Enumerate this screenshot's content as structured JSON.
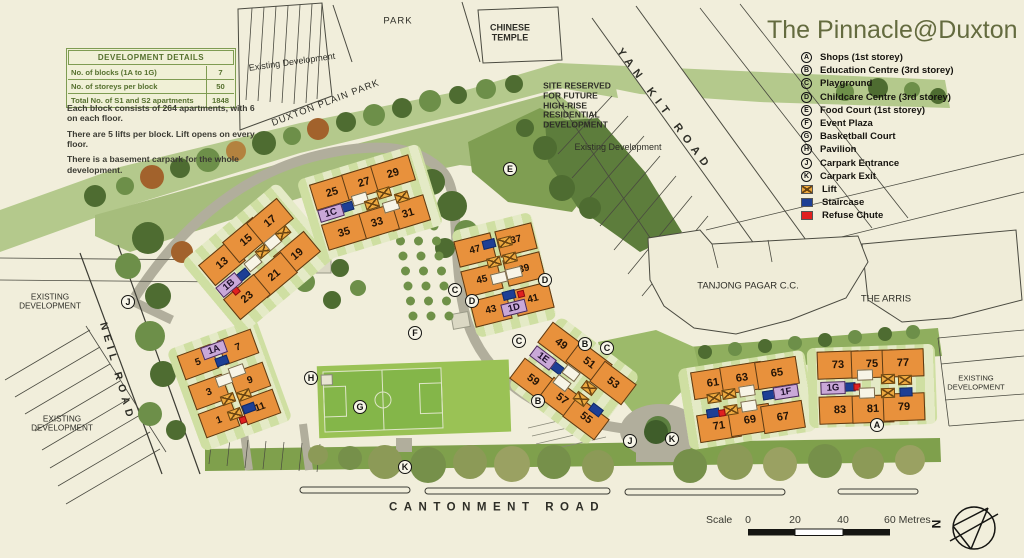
{
  "title": "The Pinnacle@Duxton",
  "legend": {
    "items": [
      {
        "symbol": "A",
        "label": "Shops (1st storey)"
      },
      {
        "symbol": "B",
        "label": "Education Centre (3rd storey)"
      },
      {
        "symbol": "C",
        "label": "Playground"
      },
      {
        "symbol": "D",
        "label": "Childcare Centre (3rd storey)"
      },
      {
        "symbol": "E",
        "label": "Food Court (1st storey)"
      },
      {
        "symbol": "F",
        "label": "Event Plaza"
      },
      {
        "symbol": "G",
        "label": "Basketball Court"
      },
      {
        "symbol": "H",
        "label": "Pavilion"
      },
      {
        "symbol": "J",
        "label": "Carpark Entrance"
      },
      {
        "symbol": "K",
        "label": "Carpark Exit"
      },
      {
        "swatch": "lift",
        "label": "Lift"
      },
      {
        "swatch": "staircase",
        "label": "Staircase"
      },
      {
        "swatch": "refuse",
        "label": "Refuse Chute"
      }
    ]
  },
  "details": {
    "header": "DEVELOPMENT DETAILS",
    "rows": [
      {
        "label": "No. of blocks (1A to 1G)",
        "value": "7"
      },
      {
        "label": "No. of storeys per block",
        "value": "50"
      },
      {
        "label": "Total No. of S1 and S2 apartments",
        "value": "1848"
      }
    ]
  },
  "notes": [
    "Each block consists of 264 apartments, with 6 on each floor.",
    "There are 5 lifts per block. Lift opens on every floor.",
    "There is a basement carpark for the whole development."
  ],
  "scale": {
    "label": "Scale",
    "t0": "0",
    "t20": "20",
    "t40": "40",
    "t60": "60 Metres",
    "north": "N"
  },
  "colors": {
    "building": "#e8913c",
    "lift": "#eda93f",
    "staircase": "#1d3f95",
    "refuse_chute": "#e02020",
    "block_label": "#c9a8d8",
    "park_band": "#b4c98c",
    "title_text": "#646b3f",
    "background": "#f1eedb"
  },
  "map": {
    "area_labels": [
      {
        "text": "PARK",
        "x": 398,
        "y": 22,
        "size": 9.5,
        "ls": 1
      },
      {
        "text": "CHINESE\nTEMPLE",
        "x": 510,
        "y": 33,
        "size": 9,
        "bold": true
      },
      {
        "text": "Existing Development",
        "x": 292,
        "y": 62,
        "rot": -8,
        "size": 9
      },
      {
        "text": "DUXTON PLAIN PARK",
        "x": 326,
        "y": 104,
        "rot": -21,
        "size": 9.5,
        "ls": 1
      },
      {
        "text": "SITE RESERVED\nFOR FUTURE\nHIGH-RISE\nRESIDENTIAL\nDEVELOPMENT",
        "x": 577,
        "y": 106,
        "size": 8.5,
        "bold": true,
        "align": "left"
      },
      {
        "text": "YAN KIT ROAD",
        "x": 664,
        "y": 110,
        "rot": 53,
        "size": 11,
        "bold": true,
        "ls": 6
      },
      {
        "text": "Existing Development",
        "x": 618,
        "y": 147,
        "size": 9
      },
      {
        "text": "TANJONG PAGAR C.C.",
        "x": 748,
        "y": 287,
        "size": 9.5
      },
      {
        "text": "THE ARRIS",
        "x": 886,
        "y": 300,
        "size": 9.5
      },
      {
        "text": "EXISTING\nDEVELOPMENT",
        "x": 976,
        "y": 383,
        "size": 7.6
      },
      {
        "text": "EXISTING\nDEVELOPMENT",
        "x": 50,
        "y": 302,
        "size": 8.2
      },
      {
        "text": "NEIL ROAD",
        "x": 117,
        "y": 372,
        "rot": 74,
        "size": 10.5,
        "bold": true,
        "ls": 5
      },
      {
        "text": "EXISTING\nDEVELOPMENT",
        "x": 62,
        "y": 424,
        "size": 8.2
      },
      {
        "text": "CANTONMENT ROAD",
        "x": 497,
        "y": 508,
        "size": 11.5,
        "bold": true,
        "ls": 6.5
      }
    ],
    "blocks": [
      {
        "id": "1A",
        "rot": -20,
        "uw": 36,
        "uh": 26,
        "fs": 10,
        "lawn": [
          95,
          108
        ],
        "lx": 214,
        "ly": 350,
        "units": [
          {
            "n": "5",
            "x": 198,
            "y": 362
          },
          {
            "n": "7",
            "x": 238,
            "y": 347
          },
          {
            "n": "3",
            "x": 209,
            "y": 392
          },
          {
            "n": "9",
            "x": 250,
            "y": 380
          },
          {
            "n": "1",
            "x": 219,
            "y": 420
          },
          {
            "n": "11",
            "x": 260,
            "y": 407
          }
        ],
        "deco": [
          {
            "t": "stair",
            "x": 222,
            "y": 361
          },
          {
            "t": "white",
            "x": 224,
            "y": 380
          },
          {
            "t": "white",
            "x": 237,
            "y": 371
          },
          {
            "t": "lift",
            "x": 228,
            "y": 399
          },
          {
            "t": "lift",
            "x": 244,
            "y": 395
          },
          {
            "t": "lift",
            "x": 235,
            "y": 414
          },
          {
            "t": "stair",
            "x": 249,
            "y": 408
          },
          {
            "t": "red",
            "x": 243,
            "y": 420
          }
        ]
      },
      {
        "id": "1B",
        "rot": -40,
        "uw": 40,
        "uh": 27,
        "fs": 11,
        "lawn": [
          125,
          95
        ],
        "lx": 229,
        "ly": 285,
        "units": [
          {
            "n": "13",
            "x": 222,
            "y": 263
          },
          {
            "n": "15",
            "x": 246,
            "y": 240
          },
          {
            "n": "17",
            "x": 270,
            "y": 221
          },
          {
            "n": "19",
            "x": 297,
            "y": 254
          },
          {
            "n": "21",
            "x": 274,
            "y": 275
          },
          {
            "n": "23",
            "x": 247,
            "y": 297
          }
        ],
        "deco": [
          {
            "t": "stair",
            "x": 243,
            "y": 275
          },
          {
            "t": "white",
            "x": 253,
            "y": 263
          },
          {
            "t": "lift",
            "x": 263,
            "y": 251
          },
          {
            "t": "white",
            "x": 273,
            "y": 242
          },
          {
            "t": "lift",
            "x": 283,
            "y": 233
          },
          {
            "t": "red",
            "x": 236,
            "y": 291
          }
        ]
      },
      {
        "id": "1C",
        "rot": -17,
        "uw": 40,
        "uh": 27,
        "fs": 11,
        "lawn": [
          128,
          85
        ],
        "lx": 331,
        "ly": 213,
        "units": [
          {
            "n": "25",
            "x": 332,
            "y": 192
          },
          {
            "n": "27",
            "x": 364,
            "y": 182
          },
          {
            "n": "29",
            "x": 393,
            "y": 173
          },
          {
            "n": "31",
            "x": 408,
            "y": 213
          },
          {
            "n": "33",
            "x": 377,
            "y": 222
          },
          {
            "n": "35",
            "x": 344,
            "y": 232
          }
        ],
        "deco": [
          {
            "t": "stair",
            "x": 347,
            "y": 207
          },
          {
            "t": "white",
            "x": 360,
            "y": 199
          },
          {
            "t": "lift",
            "x": 372,
            "y": 204
          },
          {
            "t": "lift",
            "x": 384,
            "y": 193
          },
          {
            "t": "white",
            "x": 391,
            "y": 206
          },
          {
            "t": "lift",
            "x": 402,
            "y": 197
          }
        ]
      },
      {
        "id": "1D",
        "rot": -14,
        "uw": 38,
        "uh": 27,
        "fs": 10,
        "lawn": [
          82,
          110
        ],
        "lx": 514,
        "ly": 308,
        "units": [
          {
            "n": "47",
            "x": 475,
            "y": 250
          },
          {
            "n": "37",
            "x": 516,
            "y": 240
          },
          {
            "n": "45",
            "x": 482,
            "y": 280
          },
          {
            "n": "39",
            "x": 524,
            "y": 269
          },
          {
            "n": "43",
            "x": 491,
            "y": 310
          },
          {
            "n": "41",
            "x": 533,
            "y": 299
          }
        ],
        "deco": [
          {
            "t": "stair",
            "x": 489,
            "y": 244
          },
          {
            "t": "lift",
            "x": 505,
            "y": 242
          },
          {
            "t": "lift",
            "x": 494,
            "y": 262
          },
          {
            "t": "lift",
            "x": 510,
            "y": 258
          },
          {
            "t": "white",
            "x": 499,
            "y": 278
          },
          {
            "t": "white",
            "x": 514,
            "y": 273
          },
          {
            "t": "stair",
            "x": 509,
            "y": 295
          },
          {
            "t": "red",
            "x": 521,
            "y": 294
          }
        ]
      },
      {
        "id": "1E",
        "rot": 37,
        "uw": 40,
        "uh": 26,
        "fs": 11,
        "lawn": [
          100,
          88
        ],
        "lx": 543,
        "ly": 358,
        "units": [
          {
            "n": "49",
            "x": 561,
            "y": 344
          },
          {
            "n": "51",
            "x": 589,
            "y": 363
          },
          {
            "n": "53",
            "x": 613,
            "y": 383
          },
          {
            "n": "59",
            "x": 533,
            "y": 380
          },
          {
            "n": "57",
            "x": 562,
            "y": 399
          },
          {
            "n": "55",
            "x": 586,
            "y": 418
          }
        ],
        "deco": [
          {
            "t": "stair",
            "x": 557,
            "y": 368
          },
          {
            "t": "white",
            "x": 571,
            "y": 373
          },
          {
            "t": "white",
            "x": 562,
            "y": 383
          },
          {
            "t": "lift",
            "x": 589,
            "y": 388
          },
          {
            "t": "lift",
            "x": 581,
            "y": 399
          },
          {
            "t": "stair",
            "x": 596,
            "y": 410
          }
        ]
      },
      {
        "id": "1F",
        "rot": -9,
        "uw": 42,
        "uh": 28,
        "fs": 11,
        "lawn": [
          128,
          82
        ],
        "lx": 786,
        "ly": 392,
        "units": [
          {
            "n": "61",
            "x": 713,
            "y": 383
          },
          {
            "n": "63",
            "x": 742,
            "y": 378
          },
          {
            "n": "65",
            "x": 777,
            "y": 373
          },
          {
            "n": "71",
            "x": 719,
            "y": 426
          },
          {
            "n": "69",
            "x": 750,
            "y": 420
          },
          {
            "n": "67",
            "x": 783,
            "y": 417
          }
        ],
        "deco": [
          {
            "t": "lift",
            "x": 714,
            "y": 398
          },
          {
            "t": "lift",
            "x": 729,
            "y": 394
          },
          {
            "t": "white",
            "x": 747,
            "y": 391
          },
          {
            "t": "white",
            "x": 749,
            "y": 406
          },
          {
            "t": "lift",
            "x": 731,
            "y": 410
          },
          {
            "t": "stair",
            "x": 769,
            "y": 395
          },
          {
            "t": "stair",
            "x": 713,
            "y": 413
          },
          {
            "t": "red",
            "x": 722,
            "y": 413
          }
        ]
      },
      {
        "id": "1G",
        "rot": -2,
        "uw": 42,
        "uh": 28,
        "fs": 11,
        "lawn": [
          128,
          80
        ],
        "lx": 833,
        "ly": 388,
        "units": [
          {
            "n": "73",
            "x": 838,
            "y": 365
          },
          {
            "n": "75",
            "x": 872,
            "y": 364
          },
          {
            "n": "77",
            "x": 903,
            "y": 363
          },
          {
            "n": "83",
            "x": 840,
            "y": 410
          },
          {
            "n": "81",
            "x": 873,
            "y": 409
          },
          {
            "n": "79",
            "x": 904,
            "y": 407
          }
        ],
        "deco": [
          {
            "t": "stair",
            "x": 849,
            "y": 387
          },
          {
            "t": "red",
            "x": 857,
            "y": 387
          },
          {
            "t": "white",
            "x": 865,
            "y": 375
          },
          {
            "t": "lift",
            "x": 888,
            "y": 379
          },
          {
            "t": "lift",
            "x": 905,
            "y": 380
          },
          {
            "t": "white",
            "x": 867,
            "y": 393
          },
          {
            "t": "lift",
            "x": 888,
            "y": 393
          },
          {
            "t": "stair",
            "x": 906,
            "y": 392
          }
        ]
      }
    ],
    "markers": [
      {
        "k": "J",
        "x": 128,
        "y": 302
      },
      {
        "k": "E",
        "x": 510,
        "y": 169
      },
      {
        "k": "C",
        "x": 455,
        "y": 290
      },
      {
        "k": "D",
        "x": 472,
        "y": 301
      },
      {
        "k": "D",
        "x": 545,
        "y": 280
      },
      {
        "k": "F",
        "x": 415,
        "y": 333
      },
      {
        "k": "C",
        "x": 519,
        "y": 341
      },
      {
        "k": "B",
        "x": 585,
        "y": 344
      },
      {
        "k": "C",
        "x": 607,
        "y": 348
      },
      {
        "k": "H",
        "x": 311,
        "y": 378
      },
      {
        "k": "G",
        "x": 360,
        "y": 407
      },
      {
        "k": "B",
        "x": 538,
        "y": 401
      },
      {
        "k": "K",
        "x": 405,
        "y": 467
      },
      {
        "k": "J",
        "x": 630,
        "y": 441
      },
      {
        "k": "K",
        "x": 672,
        "y": 439
      },
      {
        "k": "A",
        "x": 877,
        "y": 425
      }
    ]
  }
}
